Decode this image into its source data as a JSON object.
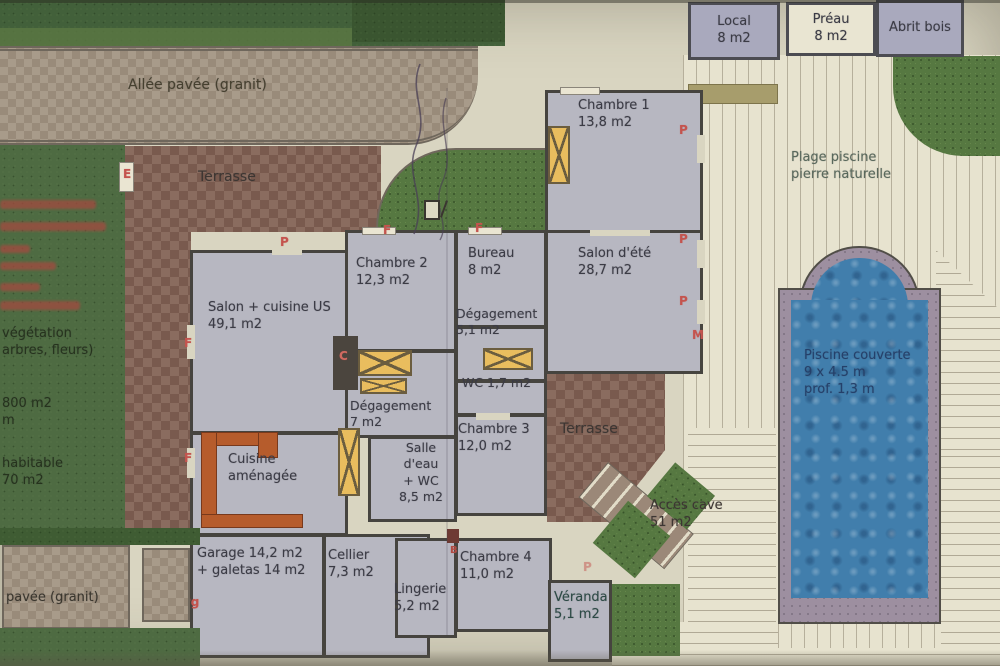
{
  "plan": {
    "allee_top_label": "Allée pavée (granit)",
    "allee_bottom_label": "pavée (granit)",
    "terrasse_top_label": "Terrasse",
    "terrasse_right_label": "Terrasse",
    "acces_cave_label": "Accès cave\n51 m2",
    "plage_label": "Plage piscine\npierre naturelle",
    "pool_label": "Piscine couverte\n9 x 4.5 m\nprof. 1,3 m",
    "outbuildings": {
      "local": "Local\n8 m2",
      "preau": "Préau\n8 m2",
      "abri": "Abrit bois"
    },
    "left_panel": {
      "vegetation": "végétation\n arbres, fleurs)",
      "terrain": "800 m2\n m",
      "habitable": "habitable\n70 m2"
    },
    "rooms": {
      "salon_cuisine": "Salon + cuisine US\n49,1 m2",
      "chambre1": "Chambre 1\n13,8 m2",
      "chambre2": "Chambre 2\n12,3 m2",
      "bureau": "Bureau\n8 m2",
      "salon_ete": "Salon d'été\n28,7 m2",
      "degagement1": "Dégagement\n5,1 m2",
      "wc": "WC 1,7 m2",
      "degagement2": "Dégagement\n7 m2",
      "chambre3": "Chambre 3\n12,0 m2",
      "cuisine": "Cuisine\naménagée",
      "salle_eau": "Salle\nd'eau\n+ WC\n8,5 m2",
      "garage": "Garage 14,2 m2\n+ galetas 14 m2",
      "cellier": "Cellier\n7,3 m2",
      "lingerie": "Lingerie\n5,2 m2",
      "chambre4": "Chambre 4\n11,0 m2",
      "veranda": "Véranda\n5,1 m2"
    },
    "markers": {
      "door": "P",
      "window": "F",
      "entry": "E",
      "chimney": "C",
      "m": "M",
      "pg": "Pg",
      "b": "B"
    },
    "colors": {
      "paper": "#d9d5c1",
      "room_fill": "#b7b7c1",
      "wall": "#46443f",
      "pool_water": "#417eac",
      "pool_coping": "#9d8fa0",
      "terrace_checker": "#8a6c5f",
      "hedge_green": "#42603a",
      "marker_red": "#c4544e",
      "wood_window": "#e9bd5e",
      "kitchen_counter": "#b65c2c"
    }
  }
}
